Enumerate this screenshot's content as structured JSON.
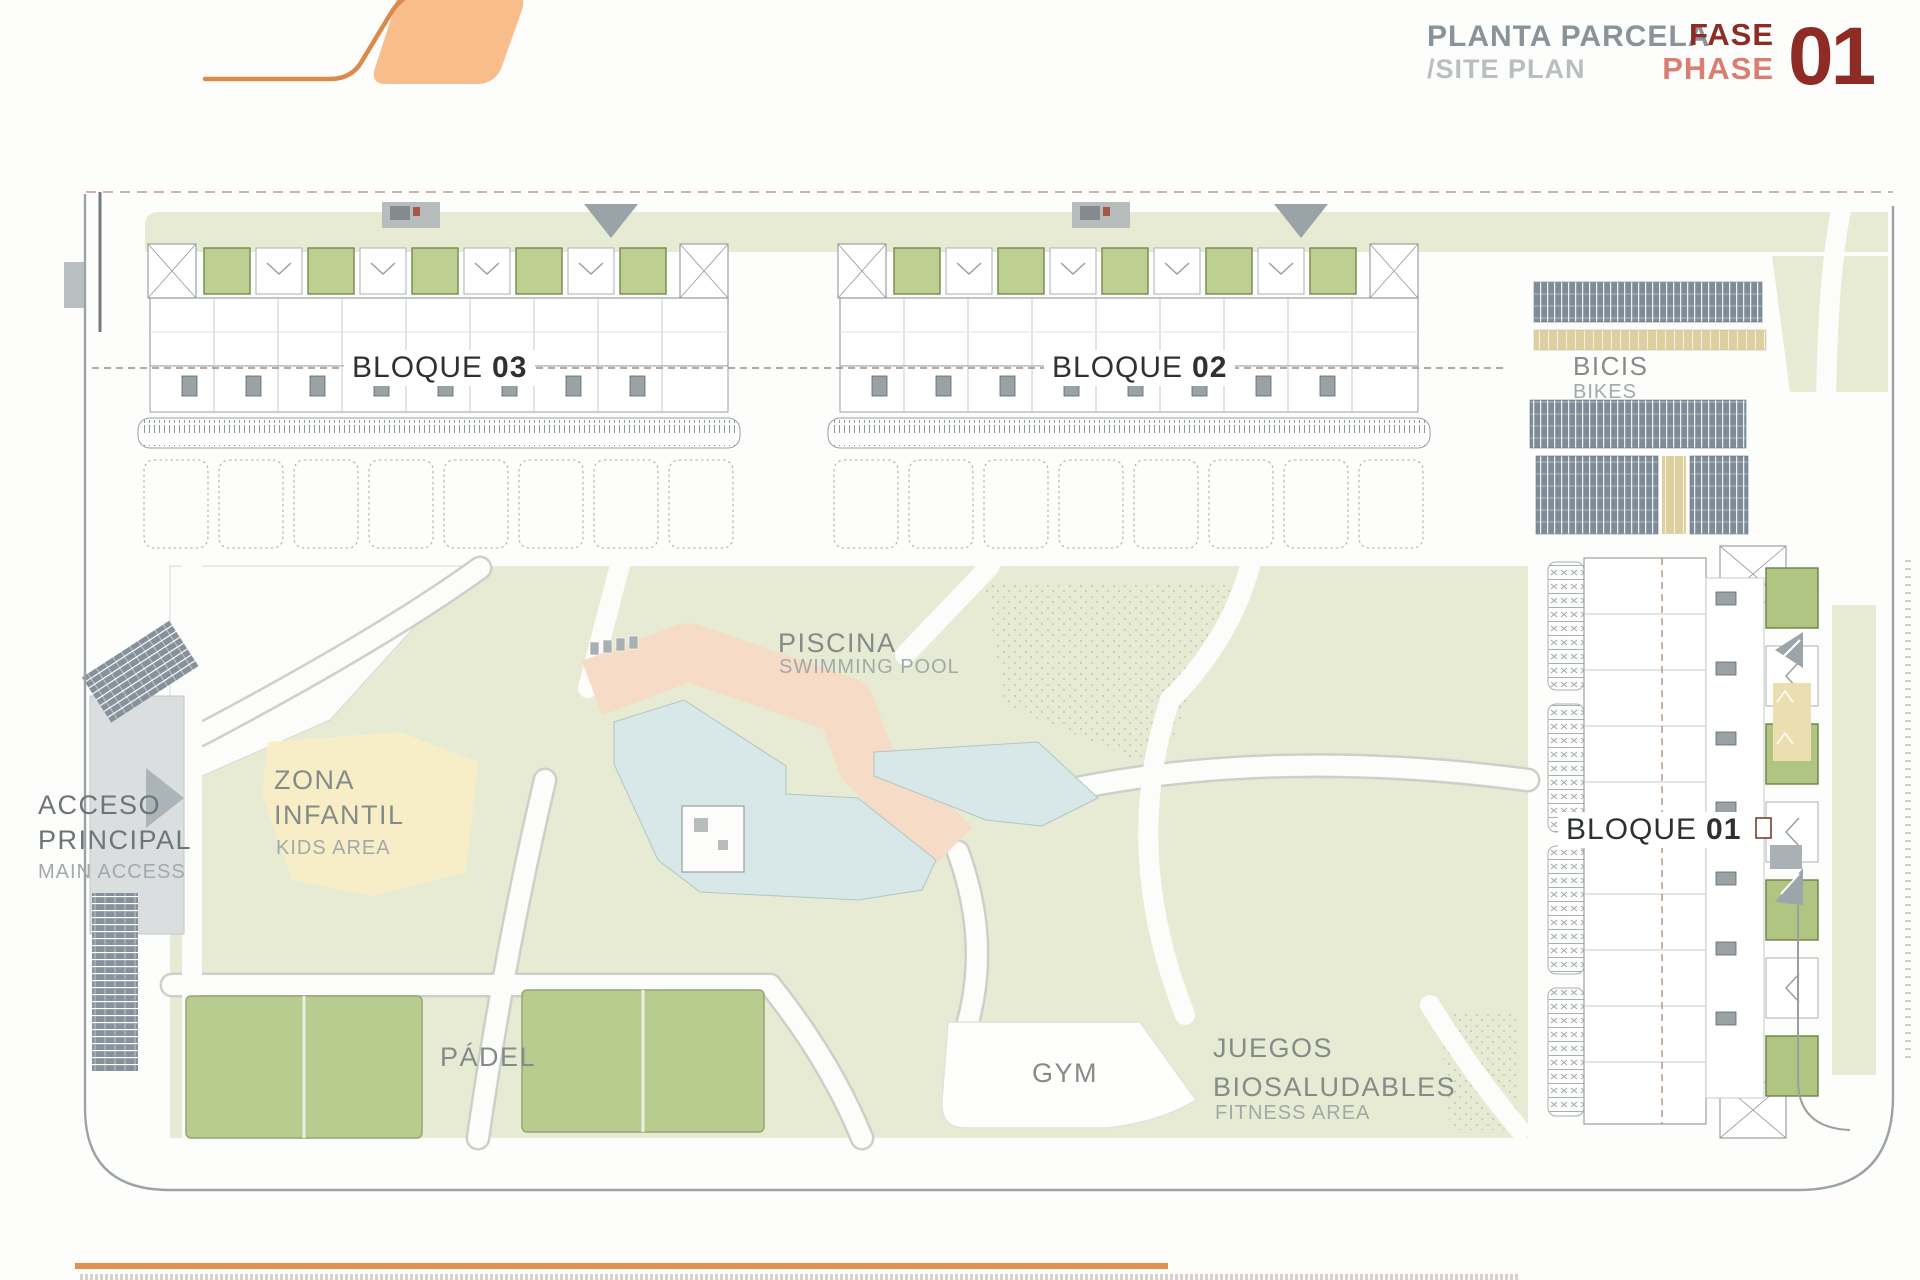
{
  "header": {
    "title_primary": "PLANTA PARCELA",
    "title_secondary": "/SITE PLAN",
    "phase_word_primary": "FASE",
    "phase_word_secondary": "PHASE",
    "phase_number": "01"
  },
  "labels": {
    "bloque03": {
      "word": "BLOQUE",
      "number": "03"
    },
    "bloque02": {
      "word": "BLOQUE",
      "number": "02"
    },
    "bloque01": {
      "word": "BLOQUE",
      "number": "01"
    },
    "bikes": {
      "primary": "BICIS",
      "secondary": "BIKES"
    },
    "pool": {
      "primary": "PISCINA",
      "secondary": "SWIMMING POOL"
    },
    "kids": {
      "line1": "ZONA",
      "line2": "INFANTIL",
      "secondary": "KIDS AREA"
    },
    "access": {
      "line1": "ACCESO",
      "line2": "PRINCIPAL",
      "secondary": "MAIN ACCESS"
    },
    "padel": {
      "primary": "PÁDEL"
    },
    "gym": {
      "primary": "GYM"
    },
    "fitness": {
      "line1": "JUEGOS",
      "line2": "BIOSALUDABLES",
      "secondary": "FITNESS AREA"
    }
  },
  "colors": {
    "accent_orange": "#E0914F",
    "logo_fill": "#F9BC8B",
    "logo_stroke": "#DC8A4C",
    "title_gray": "#8A9399",
    "title_light_gray": "#B9BEC1",
    "phase_dark_red": "#8D2B24",
    "phase_light_red": "#D97F72",
    "plan_green": "#E7EBD3",
    "patio_green": "#BDD092",
    "pool_blue": "#D8E7E7",
    "deck_salmon": "#F6DCC6",
    "kids_yellow": "#F7EEC7",
    "bike_slate": "#7E8C98",
    "bike_tan": "#DCCFA0",
    "boundary_gray": "#9AA3A5",
    "dashed_boundary": "#C79A8A",
    "label_gray": "#848B89",
    "label_light_gray": "#A2A9A9",
    "block_ink": "#2E3133"
  }
}
